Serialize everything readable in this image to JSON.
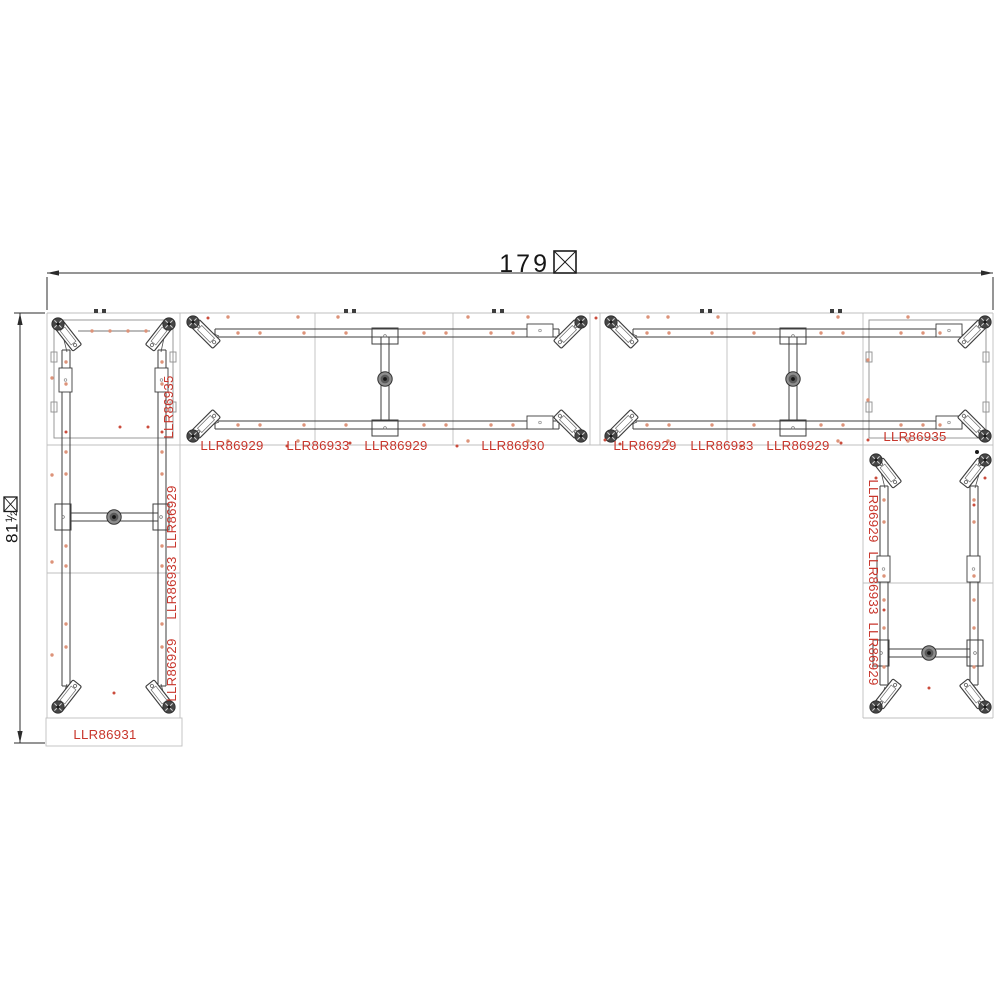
{
  "diagram": {
    "kind": "furniture-frame-assembly-plan-view",
    "shape": "u-shaped-desk-frame-layout"
  },
  "colors": {
    "line_dark": "#3d3d3d",
    "line_mid": "#8f8f8f",
    "line_light": "#bfbfbf",
    "label_red": "#c8362c",
    "hole_orange": "#dd9379",
    "hole_red": "#cb4c3c"
  },
  "dimensions": {
    "width": {
      "value": "179",
      "suffix_glyph": "missing-glyph-box"
    },
    "height": {
      "value": "81",
      "fraction_numerator": "1",
      "fraction_denominator": "2",
      "suffix_glyph": "missing-glyph-box"
    }
  },
  "part_labels": [
    {
      "text": "LLR86935",
      "x": 173,
      "y": 407,
      "rotation": -90
    },
    {
      "text": "LLR86929",
      "x": 232,
      "y": 450,
      "rotation": 0
    },
    {
      "text": "LLR86933",
      "x": 318,
      "y": 450,
      "rotation": 0
    },
    {
      "text": "LLR86929",
      "x": 396,
      "y": 450,
      "rotation": 0
    },
    {
      "text": "LLR86930",
      "x": 513,
      "y": 450,
      "rotation": 0
    },
    {
      "text": "LLR86929",
      "x": 645,
      "y": 450,
      "rotation": 0
    },
    {
      "text": "LLR86933",
      "x": 722,
      "y": 450,
      "rotation": 0
    },
    {
      "text": "LLR86929",
      "x": 798,
      "y": 450,
      "rotation": 0
    },
    {
      "text": "LLR86935",
      "x": 915,
      "y": 441,
      "rotation": 0
    },
    {
      "text": "LLR86929",
      "x": 176,
      "y": 517,
      "rotation": -90
    },
    {
      "text": "LLR86933",
      "x": 176,
      "y": 588,
      "rotation": -90
    },
    {
      "text": "LLR86929",
      "x": 176,
      "y": 670,
      "rotation": -90
    },
    {
      "text": "LLR86931",
      "x": 105,
      "y": 739,
      "rotation": 0
    },
    {
      "text": "LLR86929",
      "x": 869,
      "y": 511,
      "rotation": 90
    },
    {
      "text": "LLR86933",
      "x": 869,
      "y": 583,
      "rotation": 90
    },
    {
      "text": "LLR86929",
      "x": 869,
      "y": 654,
      "rotation": 90
    }
  ]
}
